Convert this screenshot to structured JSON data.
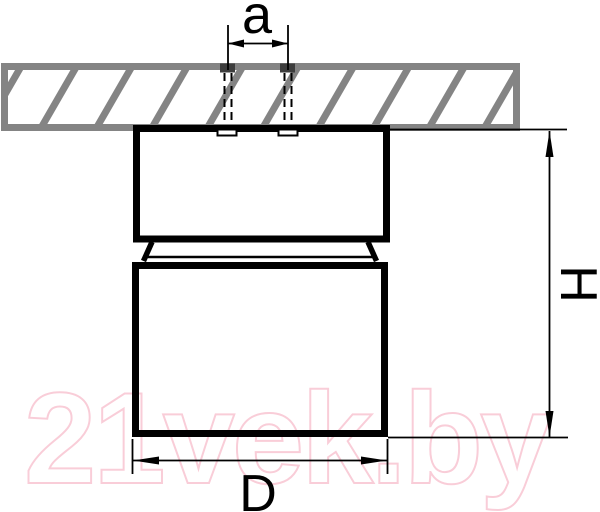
{
  "diagram": {
    "type": "technical-dimension-drawing",
    "dimensions": {
      "a": {
        "label": "a"
      },
      "D": {
        "label": "D"
      },
      "H": {
        "label": "H"
      }
    },
    "colors": {
      "line": "#000000",
      "ceiling_hatch": "#848484",
      "watermark": "#f9cdd8"
    }
  },
  "watermark": {
    "text": "21vek.by"
  }
}
